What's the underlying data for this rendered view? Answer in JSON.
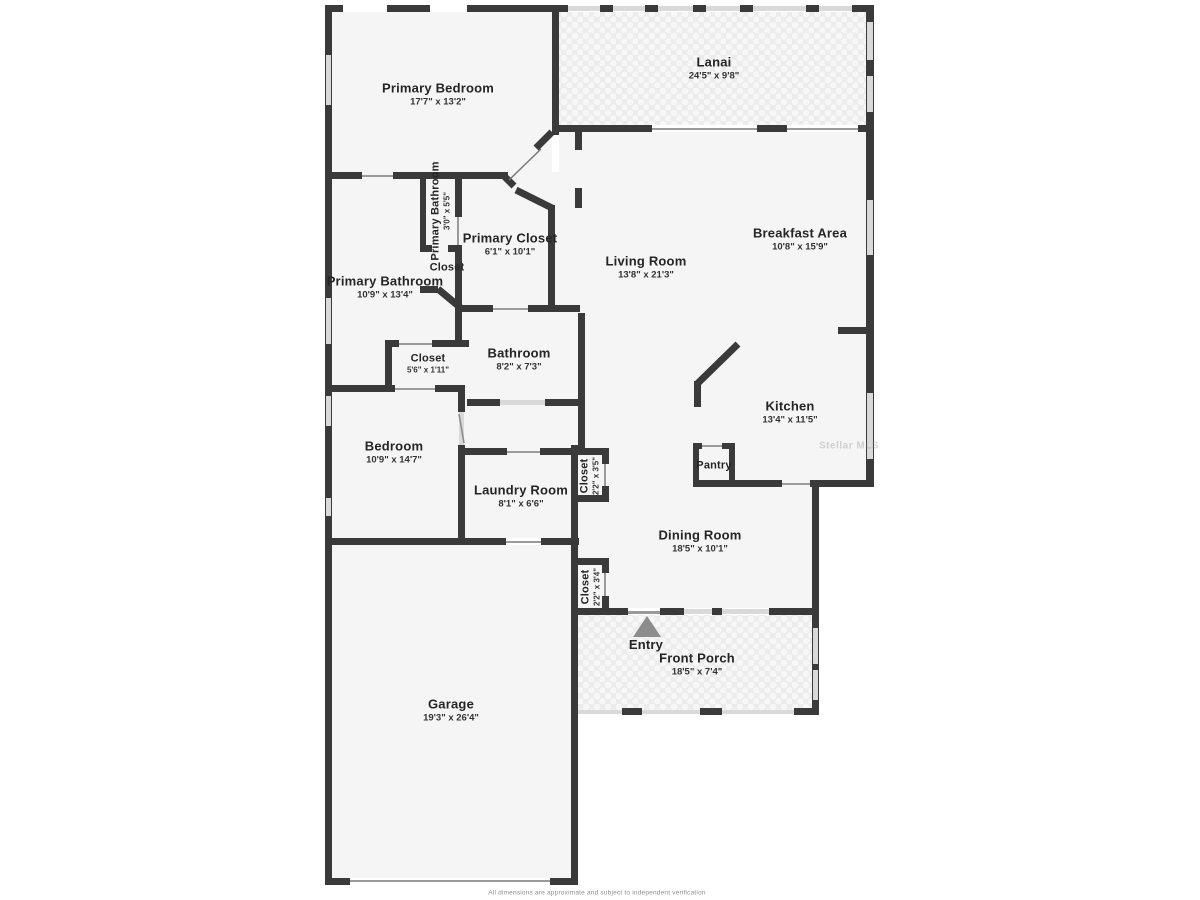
{
  "rooms": {
    "primary_bedroom": {
      "name": "Primary Bedroom",
      "dims": "17'7\" x 13'2\""
    },
    "lanai": {
      "name": "Lanai",
      "dims": "24'5\" x 9'8\""
    },
    "primary_bathroom_wc": {
      "name": "Primary Bathroom",
      "dims": "3'0\" x 5'5\""
    },
    "wc_closet": {
      "name": "Closet",
      "dims": ""
    },
    "primary_closet": {
      "name": "Primary Closet",
      "dims": "6'1\" x 10'1\""
    },
    "primary_bathroom": {
      "name": "Primary Bathroom",
      "dims": "10'9\" x 13'4\""
    },
    "living_room": {
      "name": "Living Room",
      "dims": "13'8\" x 21'3\""
    },
    "breakfast_area": {
      "name": "Breakfast Area",
      "dims": "10'8\" x 15'9\""
    },
    "bathroom": {
      "name": "Bathroom",
      "dims": "8'2\" x 7'3\""
    },
    "hall_closet": {
      "name": "Closet",
      "dims": "5'6\" x 1'11\""
    },
    "kitchen": {
      "name": "Kitchen",
      "dims": "13'4\" x 11'5\""
    },
    "pantry": {
      "name": "Pantry",
      "dims": ""
    },
    "bedroom": {
      "name": "Bedroom",
      "dims": "10'9\" x 14'7\""
    },
    "laundry_room": {
      "name": "Laundry Room",
      "dims": "8'1\" x 6'6\""
    },
    "laundry_closet": {
      "name": "Closet",
      "dims": "2'2\" x 3'5\""
    },
    "dining_room": {
      "name": "Dining Room",
      "dims": "18'5\" x 10'1\""
    },
    "entry_closet": {
      "name": "Closet",
      "dims": "2'2\" x 3'4\""
    },
    "entry": {
      "name": "Entry",
      "dims": ""
    },
    "front_porch": {
      "name": "Front Porch",
      "dims": "18'5\" x 7'4\""
    },
    "garage": {
      "name": "Garage",
      "dims": "19'3\" x 26'4\""
    }
  },
  "colors": {
    "wall": "#3a3a3a",
    "room_fill": "#f5f5f5",
    "tile_fill": "#ececec",
    "window": "#d9d9d9"
  },
  "watermark": "Stellar MLS",
  "disclaimer": "All dimensions are approximate and subject to independent verification"
}
